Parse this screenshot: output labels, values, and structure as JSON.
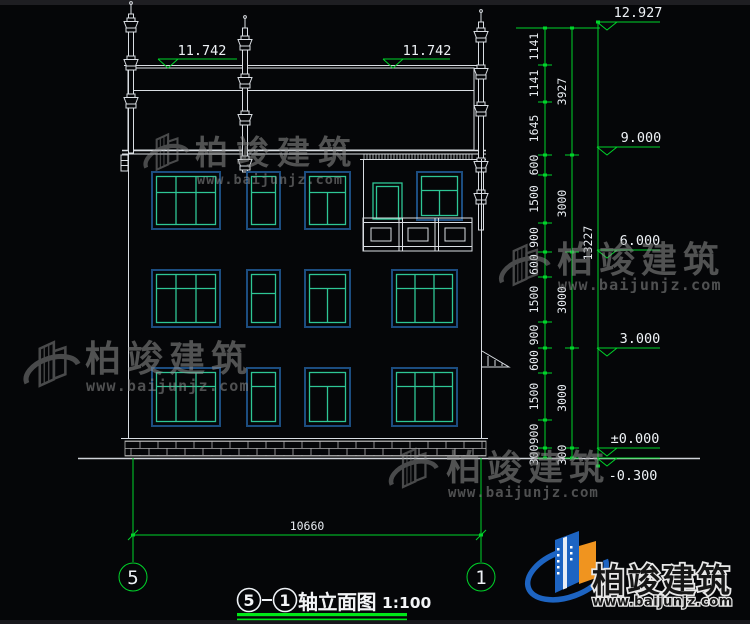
{
  "colors": {
    "background": "#050608",
    "cad_line_white": "#d9dde2",
    "dim_green": "#00d42a",
    "underline_green": "#00e818",
    "window_frame_blue": "#1c4d80",
    "window_mullion_green": "#2ec695",
    "watermark_gray": "#909090",
    "logo_blue": "#1d64c2",
    "logo_orange": "#f0941f"
  },
  "roof_levels": {
    "left": "11.742",
    "right": "11.742"
  },
  "levels": [
    "12.927",
    "9.000",
    "6.000",
    "3.000",
    "±0.000",
    "-0.300"
  ],
  "dims": {
    "chain1": [
      "1141",
      "1141",
      "1645",
      "600",
      "1500",
      "900",
      "600",
      "1500",
      "900",
      "600",
      "1500",
      "900",
      "300"
    ],
    "chain2": [
      "3927",
      "3000",
      "3000",
      "3000",
      "300"
    ],
    "chain3": [
      "13227"
    ],
    "bottom_width": "10660"
  },
  "axes": {
    "left": "5",
    "right": "1"
  },
  "title": {
    "axis_from": "5",
    "axis_to": "1",
    "name": "轴立面图",
    "scale": "1:100"
  },
  "watermark": {
    "brand": "柏竣建筑",
    "url": "www.baijunjz.com"
  },
  "footer": {
    "brand": "柏竣建筑",
    "url": "www.baijunjz.com"
  }
}
